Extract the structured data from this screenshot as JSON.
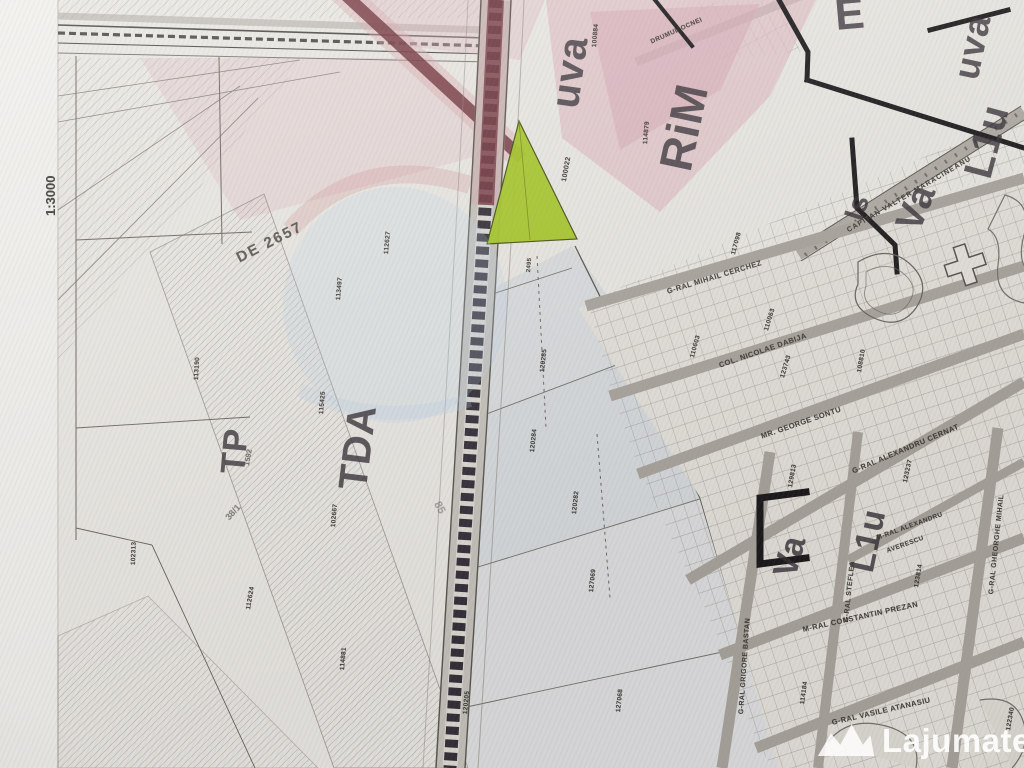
{
  "map": {
    "scale_label": "1:3000",
    "zone_labels": {
      "rim": "RiM",
      "e": "E",
      "is": "Is",
      "va": "Va",
      "l1u_top": "L1u",
      "uva_top": "uva",
      "uva_corner": "uva",
      "tp": "TP",
      "tda": "TDA",
      "va_bottom": "Va",
      "l1u_bottom": "L1u"
    },
    "street_names": {
      "ocnei": "DRUMUL OCNEI",
      "maracineanu": "CAPITAN VALTER MARACINEANU",
      "cerchez": "G-RAL MIHAIL CERCHEZ",
      "dabija": "COL. NICOLAE DABIJA",
      "sontu": "MR. GEORGE SONTU",
      "cernat": "G-RAL ALEXANDRU CERNAT",
      "prezan": "M-RAL CONSTANTIN PREZAN",
      "atanasiu": "G-RAL VASILE ATANASIU",
      "bastan": "G-RAL GRIGORE BASTAN",
      "steflea": "G-RAL STEFLEA",
      "gheorghe_mihail": "G-RAL GHEORGHE MIHAIL",
      "averescu_line1": "M-RAL ALEXANDRU",
      "averescu_line2": "AVERESCU"
    },
    "road_labels": {
      "de2657": "DE 2657",
      "lot38": "38/1",
      "n1592": "1592",
      "n85": "85"
    },
    "parcel_numbers": {
      "p113190": "113190",
      "p113497": "113497",
      "p112627": "112627",
      "p115425": "115425",
      "p102667": "102667",
      "p102313": "102313",
      "p112624": "112624",
      "p114881": "114881",
      "p100022": "100022",
      "p2495": "2495",
      "p120285": "120285",
      "p120284": "120284",
      "p120282": "120282",
      "p127069": "127069",
      "p127068": "127068",
      "p120205": "120205",
      "p114879": "114879",
      "p100884": "100884",
      "p110603": "110603",
      "p117098": "117098",
      "p110063": "110063",
      "p123743": "123743",
      "p108810": "108810",
      "p123237": "123237",
      "p123814": "123814",
      "p129813": "129813",
      "p114184": "114184",
      "p122340": "122340"
    },
    "colors": {
      "highlight_green": "#a6c827",
      "zone_pink": "#e0bcc4",
      "road_maroon": "#6e3038",
      "wash_blue": "#c3cdd9",
      "paper": "#eae8e3"
    }
  },
  "watermark": {
    "name": "Lajumate",
    "tld": ".ro"
  }
}
